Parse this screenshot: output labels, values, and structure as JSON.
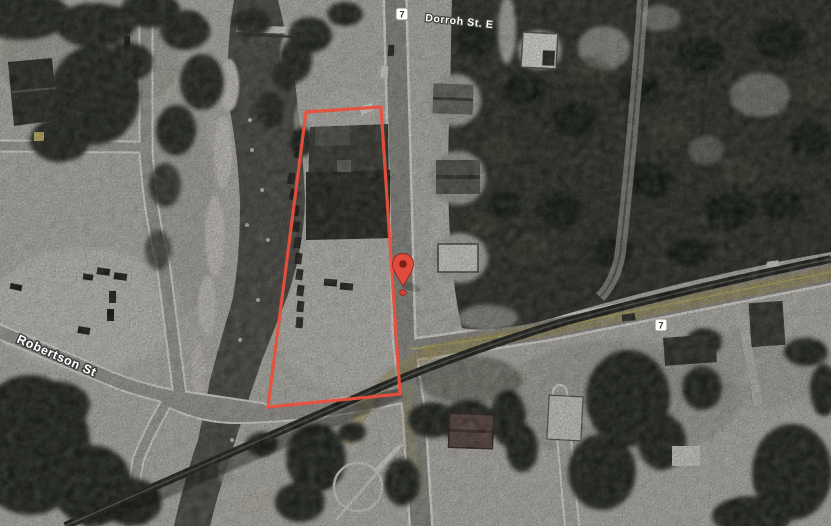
{
  "map": {
    "view_type": "satellite",
    "street_labels": [
      {
        "id": "dorroh",
        "text": "Dorroh St. E"
      },
      {
        "id": "robertson",
        "text": "Robertson St"
      }
    ],
    "route_shields": [
      {
        "number": "7",
        "position": "top-main-road"
      },
      {
        "number": "7",
        "position": "east-road"
      }
    ],
    "parcel_outline": {
      "color": "#e8503c",
      "points": "306,112 381,107 400,394 268,407"
    },
    "marker": {
      "icon": "map-pin-icon",
      "body_color": "#df4b3c",
      "dot_color": "#7c1d16"
    },
    "route_highlight_color": "#a89a55"
  }
}
